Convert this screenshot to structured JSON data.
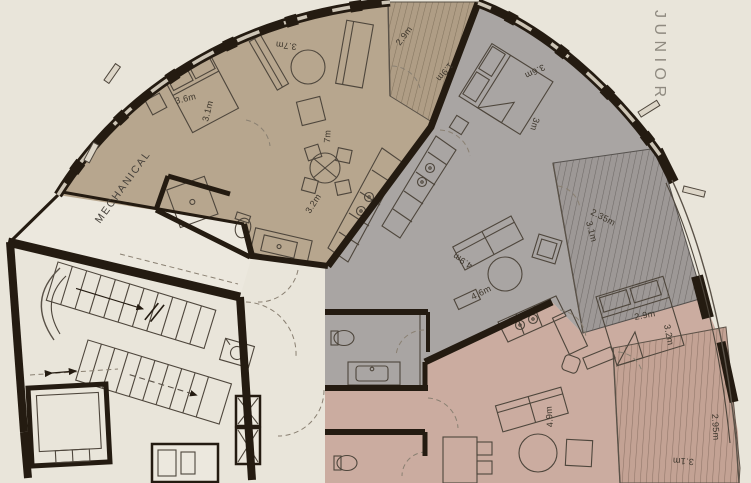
{
  "plan": {
    "building_label": "JUNIOR",
    "rooms": {
      "mechanical": "MECHANICAL"
    },
    "colors": {
      "background": "#e9e5da",
      "walls": "#241b11",
      "unit_tan": "#b7a68e",
      "unit_gray": "#a9a5a3",
      "unit_pink": "#cbaca0"
    },
    "dims": {
      "tan_bed_w": "3.6m",
      "tan_bed_d": "3.1m",
      "tan_wardrobe": "3.7m",
      "tan_living": "7m",
      "tan_kitchen": "3.2m",
      "tan_balcony_w": "2.9m",
      "tan_balcony_d": "1.9m",
      "gray_bed_w": "3.6m",
      "gray_bed_d": "3m",
      "gray_living_w": "4.9m",
      "gray_living_d": "4.6m",
      "gray_balcony_l": "2.35m",
      "gray_balcony_w": "3.1m",
      "pink_bed_w": "2.9m",
      "pink_bed_d": "3.2m",
      "pink_living": "4.9m",
      "pink_balcony_d": "2.95m",
      "pink_balcony_w": "3.1m"
    }
  }
}
